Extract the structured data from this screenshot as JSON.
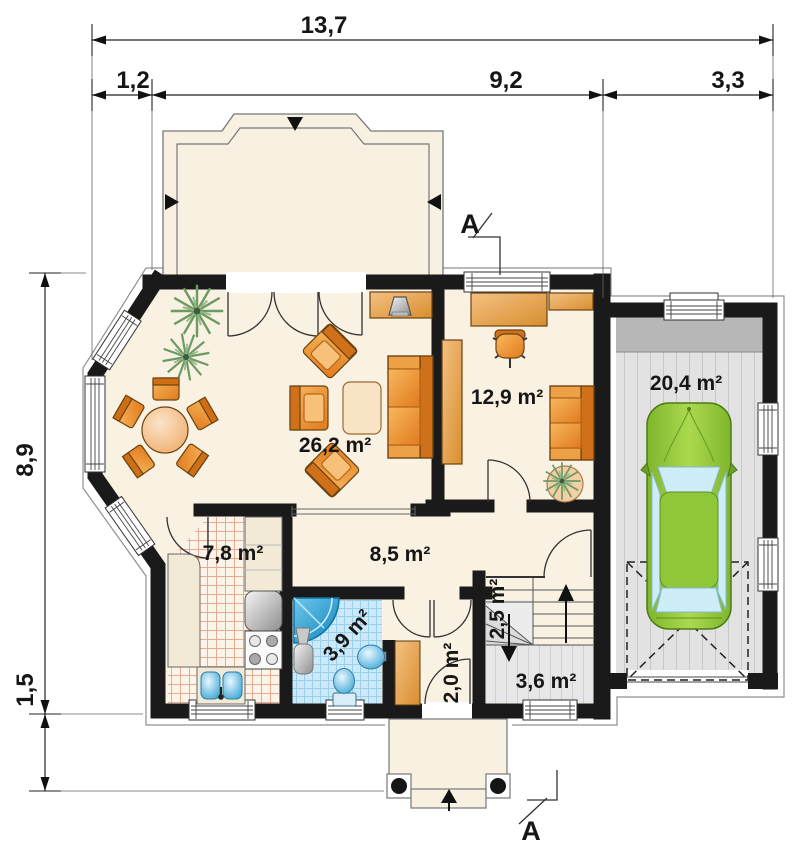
{
  "dimensions": {
    "total_width": "13,7",
    "width_segments": [
      "1,2",
      "9,2",
      "3,3"
    ],
    "height_segments": [
      "8,9",
      "1,5"
    ]
  },
  "section_marker": "A",
  "rooms": {
    "living": "26,2 m²",
    "study": "12,9 m²",
    "garage": "20,4 m²",
    "kitchen": "7,8 m²",
    "hall": "8,5 m²",
    "bathroom": "3,9 m²",
    "stairs": "2,5 m²",
    "entry": "2,0 m²",
    "vestibule": "3,6 m²"
  },
  "colors": {
    "wall": "#1a1a1a",
    "floor": "#f9f2e2",
    "furniture_orange": "#ef9232",
    "car_green": "#8cc63e",
    "fixture_blue": "#2fa3d6",
    "garage_floor": "#e0e0e0",
    "kitchen_tile_line": "#e7ab92",
    "bath_tile_line": "#9cd0ea"
  }
}
